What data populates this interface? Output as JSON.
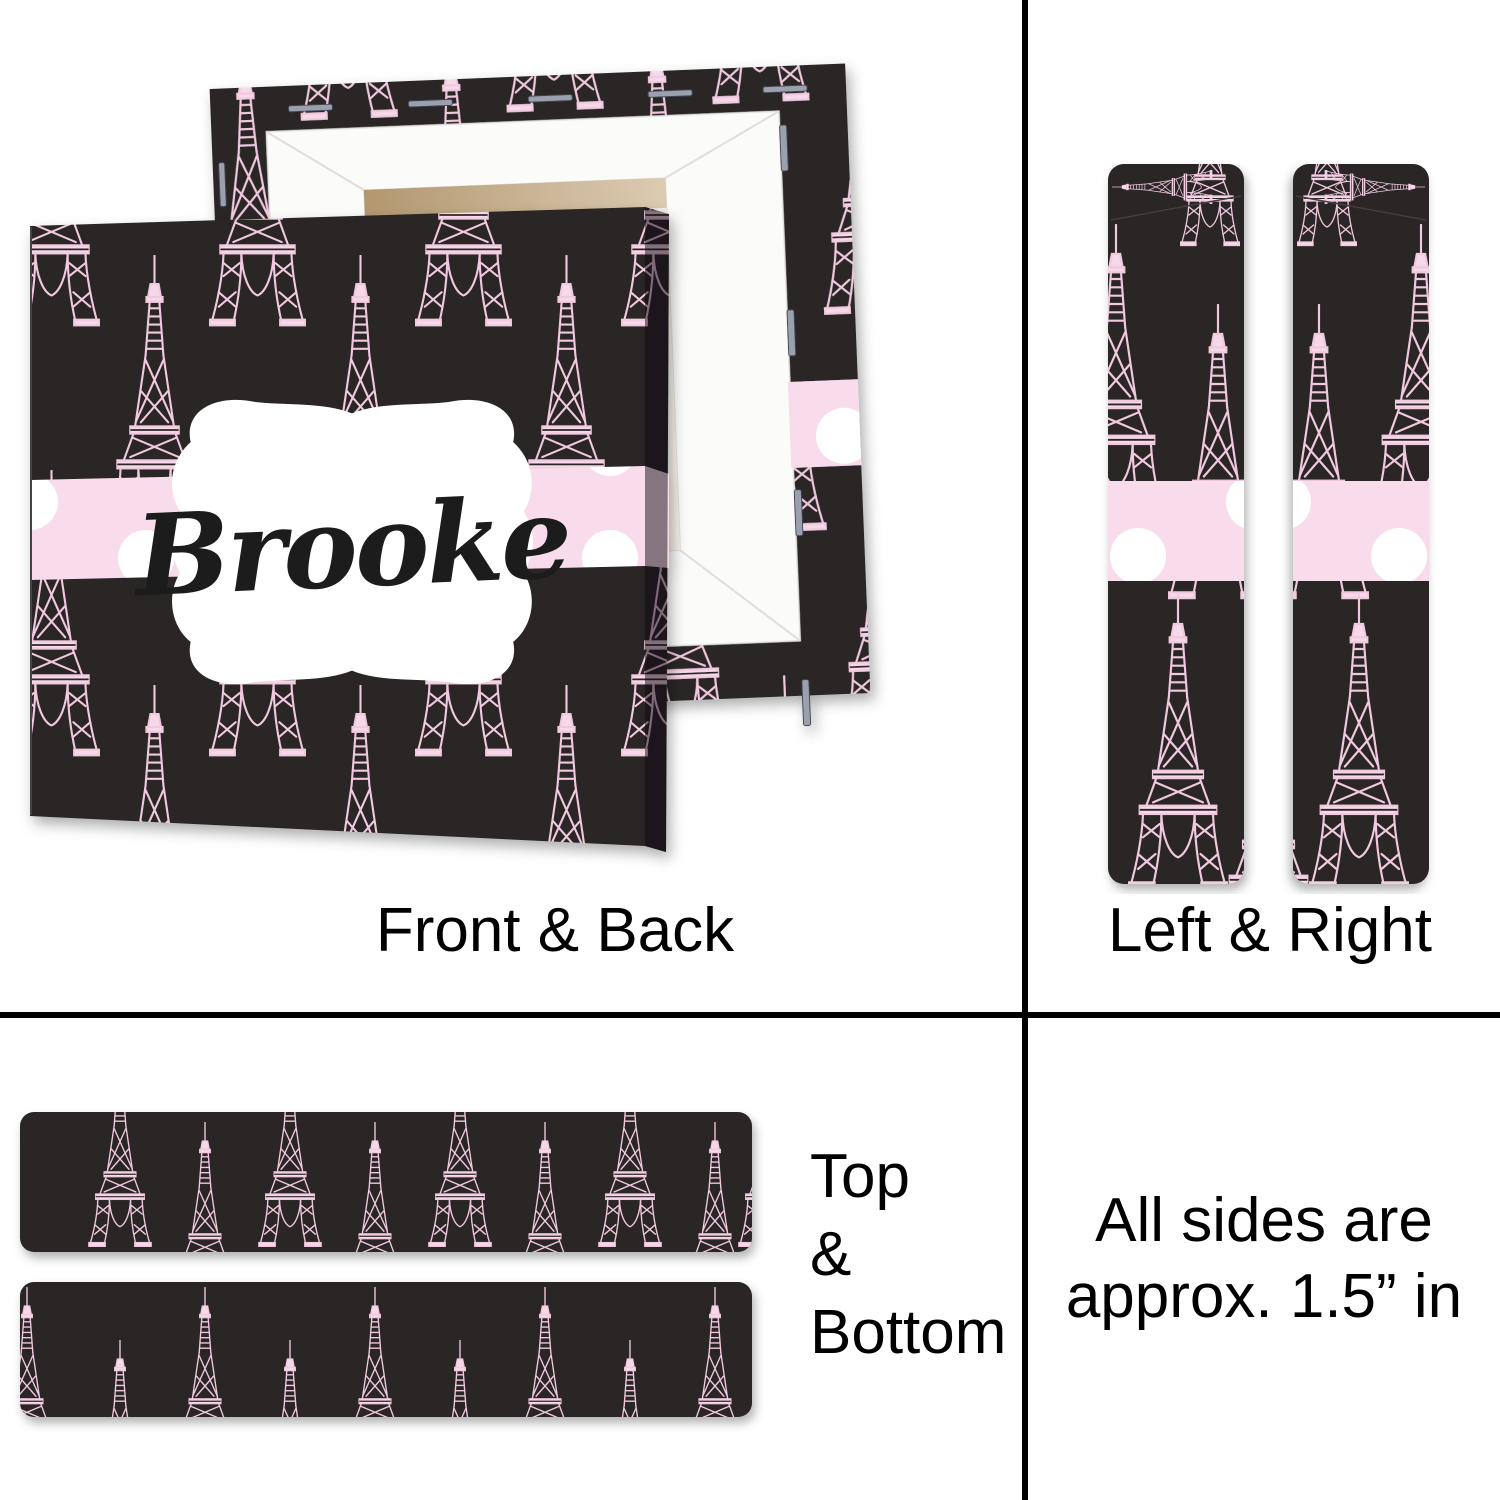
{
  "page": {
    "background": "#ffffff",
    "divider_color": "#000000"
  },
  "personalization": {
    "name": "Brooke"
  },
  "sections": {
    "front_back": {
      "label": "Front & Back"
    },
    "left_right": {
      "label": "Left & Right"
    },
    "top_bottom": {
      "line1": "Top",
      "line2": "&",
      "line3": "Bottom"
    },
    "note": {
      "line1": "All sides are",
      "line2": "approx. 1.5” in"
    }
  },
  "design": {
    "motif": "eiffel-tower-pattern",
    "pattern_background": "#2a2527",
    "tower_outline_pink": "#f0c9de",
    "tower_fill_pink": "#f6d9e9",
    "ribbon_pink": "#f8dcec",
    "ribbon_dot_white": "#ffffff",
    "plaque_white": "#ffffff",
    "name_text_color": "#1b1b1b",
    "stretcher_white": "#fbfbfa",
    "wood_tan": "#c9b190",
    "staple_silver": "#9aa0ad"
  }
}
